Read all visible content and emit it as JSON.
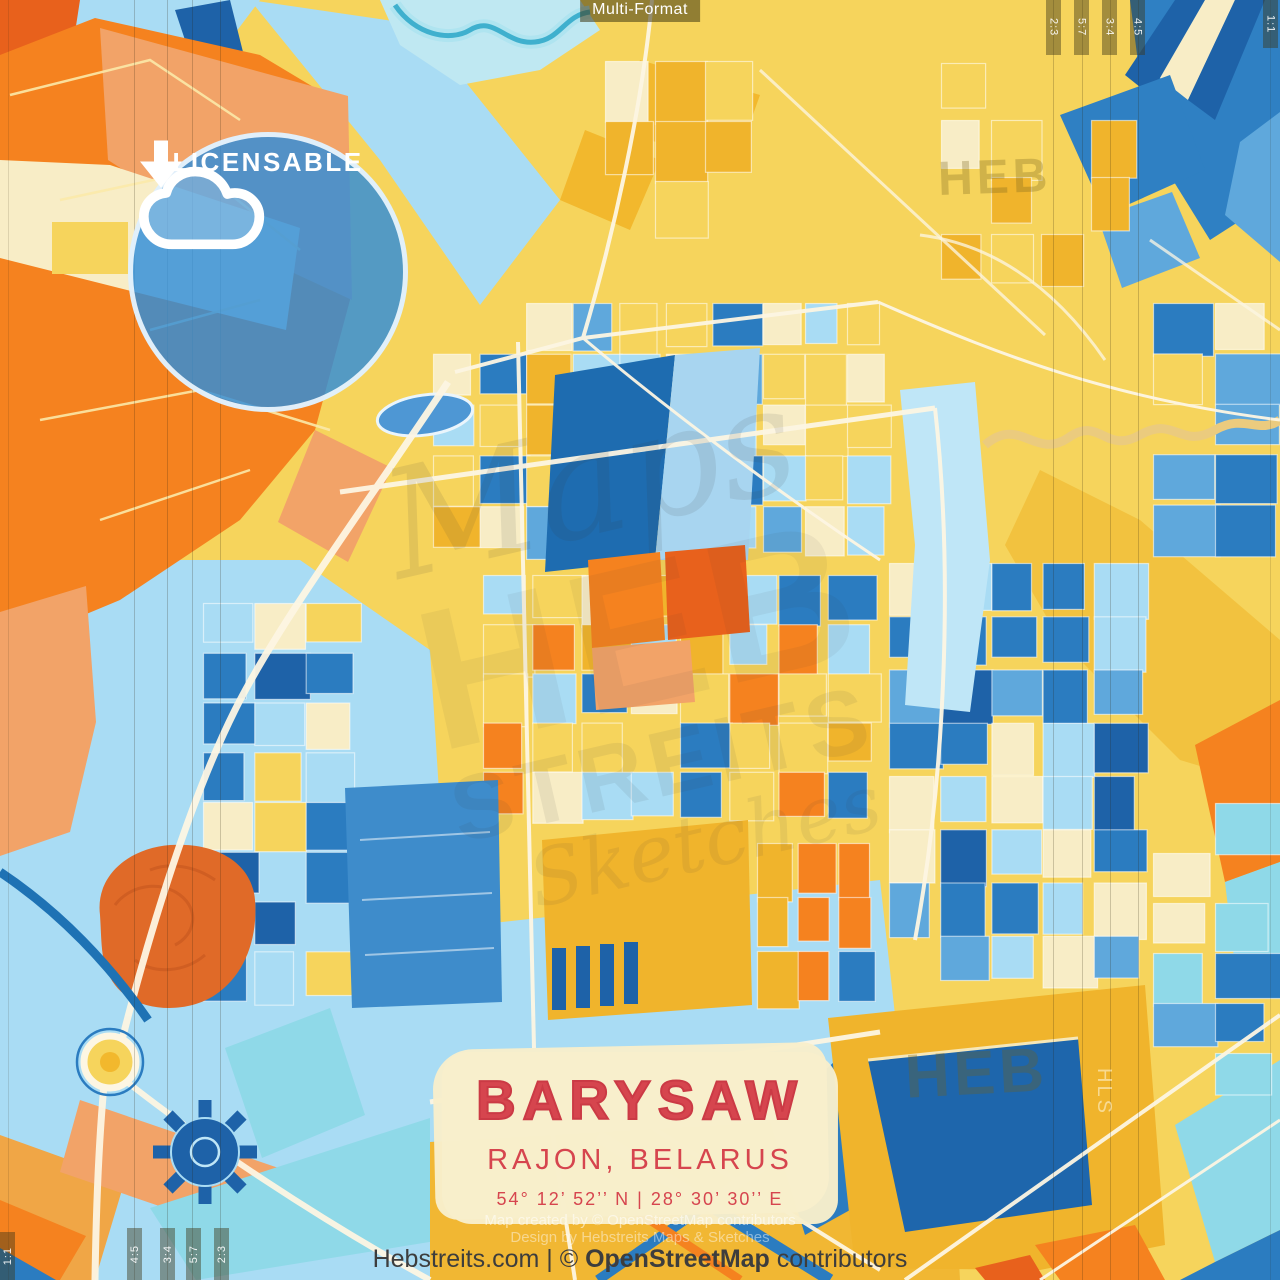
{
  "header": {
    "format_label": "Multi-Format"
  },
  "badge": {
    "label": "LICENSABLE",
    "icon": "cloud-download-icon"
  },
  "crop_ratios": {
    "top_right": [
      "2:3",
      "5:7",
      "3:4",
      "4:5"
    ],
    "top_right_corner": "1:1",
    "bottom_left": [
      "4:5",
      "3:4",
      "5:7",
      "2:3"
    ],
    "bottom_left_corner": "1:1"
  },
  "title_card": {
    "city": "BARYSAW",
    "region": "RAJON, BELARUS",
    "coordinates": "54°  12’  52’’ N  |  28°  30’  30’’ E"
  },
  "watermarks": {
    "center_script": "Maps",
    "center_heb": "HEB",
    "center_streits": "STREITS",
    "center_sketches": "Sketches",
    "top_right_heb": "HEB",
    "bottom_right_heb": "HEB",
    "side_vertical": "HLS"
  },
  "attribution_overlay": {
    "line1": "Map created by © OpenStreetMap contributors",
    "line2": "Design by Hebstreits Maps & Sketches"
  },
  "footer": {
    "prefix": "Hebstreits.com | © ",
    "osm": "OpenStreetMap",
    "suffix": " contributors"
  },
  "palette": {
    "orange": "#F5821F",
    "deep_orange": "#E8611C",
    "salmon": "#F2A368",
    "golden": "#F0B42C",
    "yellow": "#F6D45C",
    "cream": "#F8EDC6",
    "cyan": "#8FD9E8",
    "light_blue": "#A9DCF4",
    "azure": "#5FA8DC",
    "blue": "#2B7CC0",
    "dark_blue": "#1E62A8",
    "road_white": "#FDF6E3",
    "title_red": "#D6454E",
    "badge_blue": "#2F8EDB",
    "footer_text": "#3D3D3D"
  }
}
